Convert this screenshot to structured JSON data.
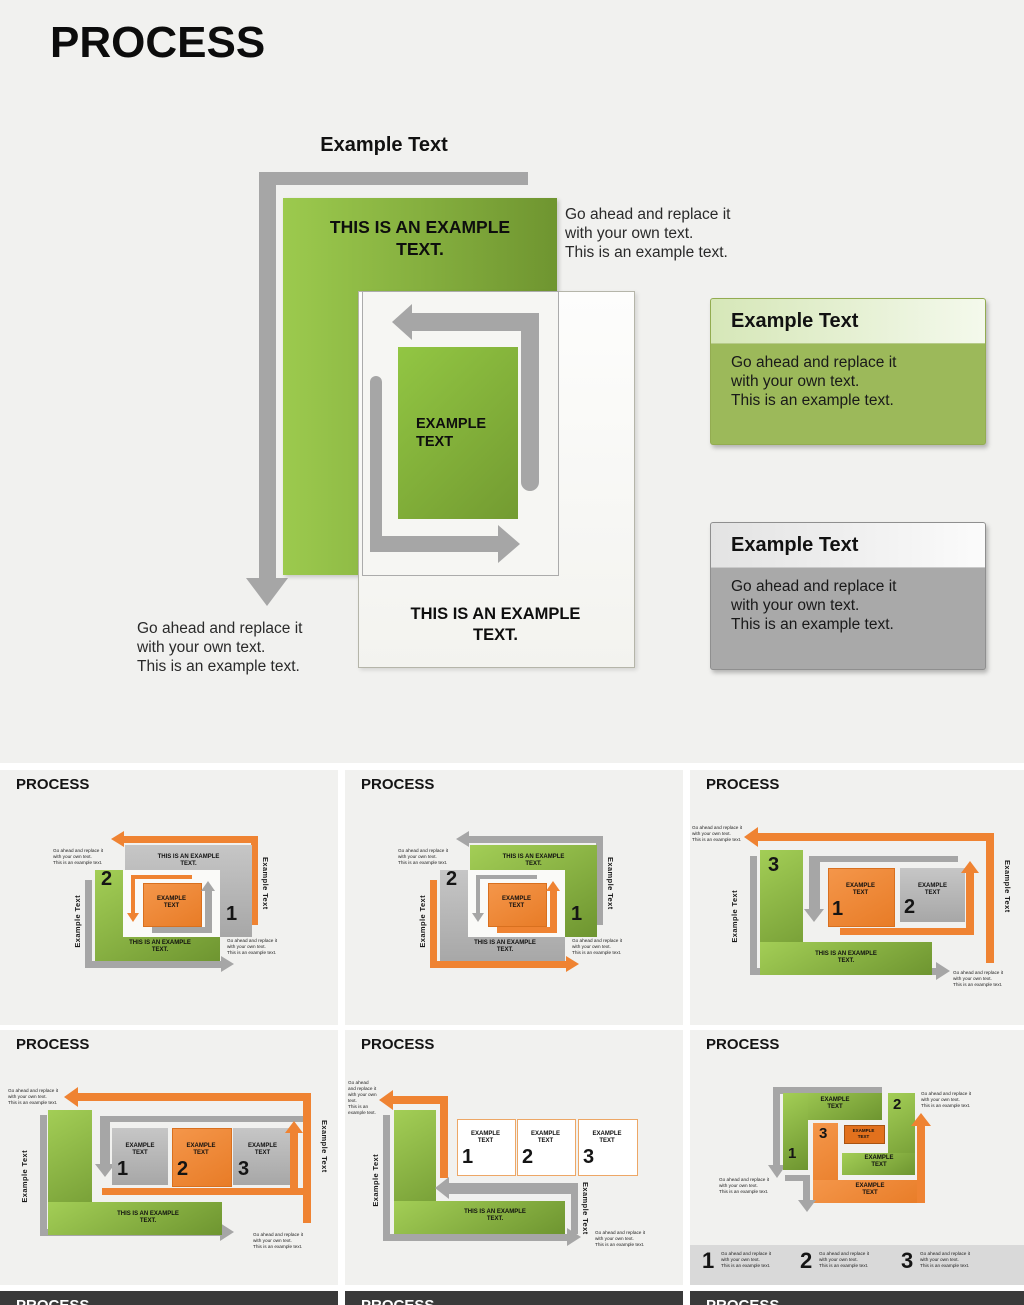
{
  "colors": {
    "green_light": "#9cca4e",
    "green_dark": "#6f9630",
    "orange": "#ef8332",
    "gray_arrow": "#a6a6a6",
    "gray_box": "#b5b5b5",
    "dark_card": "#3a3a3a",
    "legend_band": "#d9d9d9"
  },
  "main": {
    "title": "PROCESS",
    "heading": "Example Text",
    "green_box_text": "THIS IS AN EXAMPLE\nTEXT.",
    "loop_box_text": "EXAMPLE\nTEXT",
    "bottom_box_text": "THIS IS AN EXAMPLE\nTEXT.",
    "right_para": "Go ahead and replace it\nwith your own text.\nThis is an example text.",
    "bottom_left_para": "Go ahead and replace it\nwith your own text.\nThis is an example text.",
    "callouts": [
      {
        "theme": "green",
        "title": "Example Text",
        "body": "Go ahead and replace it\nwith your own text.\nThis is an example text."
      },
      {
        "theme": "gray",
        "title": "Example Text",
        "body": "Go ahead and replace it\nwith your own text.\nThis is an example text."
      }
    ]
  },
  "thumbnails": [
    {
      "title": "PROCESS",
      "para_top": "Go ahead and replace it\nwith your own text.\nThis is an example text.",
      "para_bottom": "Go ahead and replace it\nwith your own text.\nThis is an example text.",
      "vlabel_left": "Example Text",
      "vlabel_right": "Example Text",
      "back_box_text": "THIS IS AN EXAMPLE\nTEXT.",
      "back_box_num": "1",
      "front_box_num": "2",
      "front_box_text": "THIS IS AN EXAMPLE\nTEXT.",
      "center_box_text": "EXAMPLE\nTEXT"
    },
    {
      "title": "PROCESS",
      "para_top": "Go ahead and replace it\nwith your own text.\nThis is an example text.",
      "para_bottom": "Go ahead and replace it\nwith your own text.\nThis is an example text.",
      "vlabel_left": "Example Text",
      "vlabel_right": "Example Text",
      "back_box_text": "THIS IS AN EXAMPLE\nTEXT.",
      "back_box_num": "1",
      "front_box_num": "2",
      "front_box_text": "THIS IS AN EXAMPLE\nTEXT.",
      "center_box_text": "EXAMPLE\nTEXT"
    },
    {
      "title": "PROCESS",
      "para_top": "Go ahead and replace it\nwith your own text.\nThis is an example text.",
      "para_bottom": "Go ahead and replace it\nwith your own text.\nThis is an example text.",
      "vlabel_left": "Example Text",
      "vlabel_right": "Example Text",
      "l_num": "3",
      "box1_text": "EXAMPLE\nTEXT",
      "box1_num": "1",
      "box2_text": "EXAMPLE\nTEXT",
      "box2_num": "2",
      "bottom_text": "THIS IS AN EXAMPLE\nTEXT."
    },
    {
      "title": "PROCESS",
      "para_top": "Go ahead and replace it\nwith your own text.\nThis is an example text.",
      "para_bottom": "Go ahead and replace it\nwith your own text.\nThis is an example text.",
      "vlabel_left": "Example Text",
      "vlabel_right": "Example Text",
      "boxes": [
        {
          "text": "EXAMPLE\nTEXT",
          "num": "1"
        },
        {
          "text": "EXAMPLE\nTEXT",
          "num": "2"
        },
        {
          "text": "EXAMPLE\nTEXT",
          "num": "3"
        }
      ],
      "bottom_text": "THIS IS AN EXAMPLE\nTEXT."
    },
    {
      "title": "PROCESS",
      "para_top": "Go ahead\nand replace it\nwith your own\ntext.\nThis is an\nexample text.",
      "para_bottom": "Go ahead and replace it\nwith your own text.\nThis is an example text.",
      "vlabel_left": "Example Text",
      "vlabel_right": "Example Text",
      "boxes": [
        {
          "text": "EXAMPLE\nTEXT",
          "num": "1"
        },
        {
          "text": "EXAMPLE\nTEXT",
          "num": "2"
        },
        {
          "text": "EXAMPLE\nTEXT",
          "num": "3"
        }
      ],
      "bottom_text": "THIS IS AN EXAMPLE\nTEXT."
    },
    {
      "title": "PROCESS",
      "para_top_right": "Go ahead and replace it\nwith your own text.\nThis is an example text.",
      "para_left": "Go ahead and replace it\nwith your own text.\nThis is an example text.",
      "green_top_text": "EXAMPLE\nTEXT",
      "green_mid_text": "EXAMPLE\nTEXT",
      "chip_text": "EXAMPLE\nTEXT",
      "orange_bottom_text": "EXAMPLE\nTEXT",
      "num1": "1",
      "num2": "2",
      "num3": "3",
      "legend": [
        {
          "num": "1",
          "text": "Go ahead and replace it\nwith your own text.\nThis is an example text."
        },
        {
          "num": "2",
          "text": "Go ahead and replace it\nwith your own text.\nThis is an example text."
        },
        {
          "num": "3",
          "text": "Go ahead and replace it\nwith your own text.\nThis is an example text."
        }
      ]
    }
  ],
  "bottom_row": [
    {
      "title": "PROCESS"
    },
    {
      "title": "PROCESS"
    },
    {
      "title": "PROCESS"
    }
  ]
}
